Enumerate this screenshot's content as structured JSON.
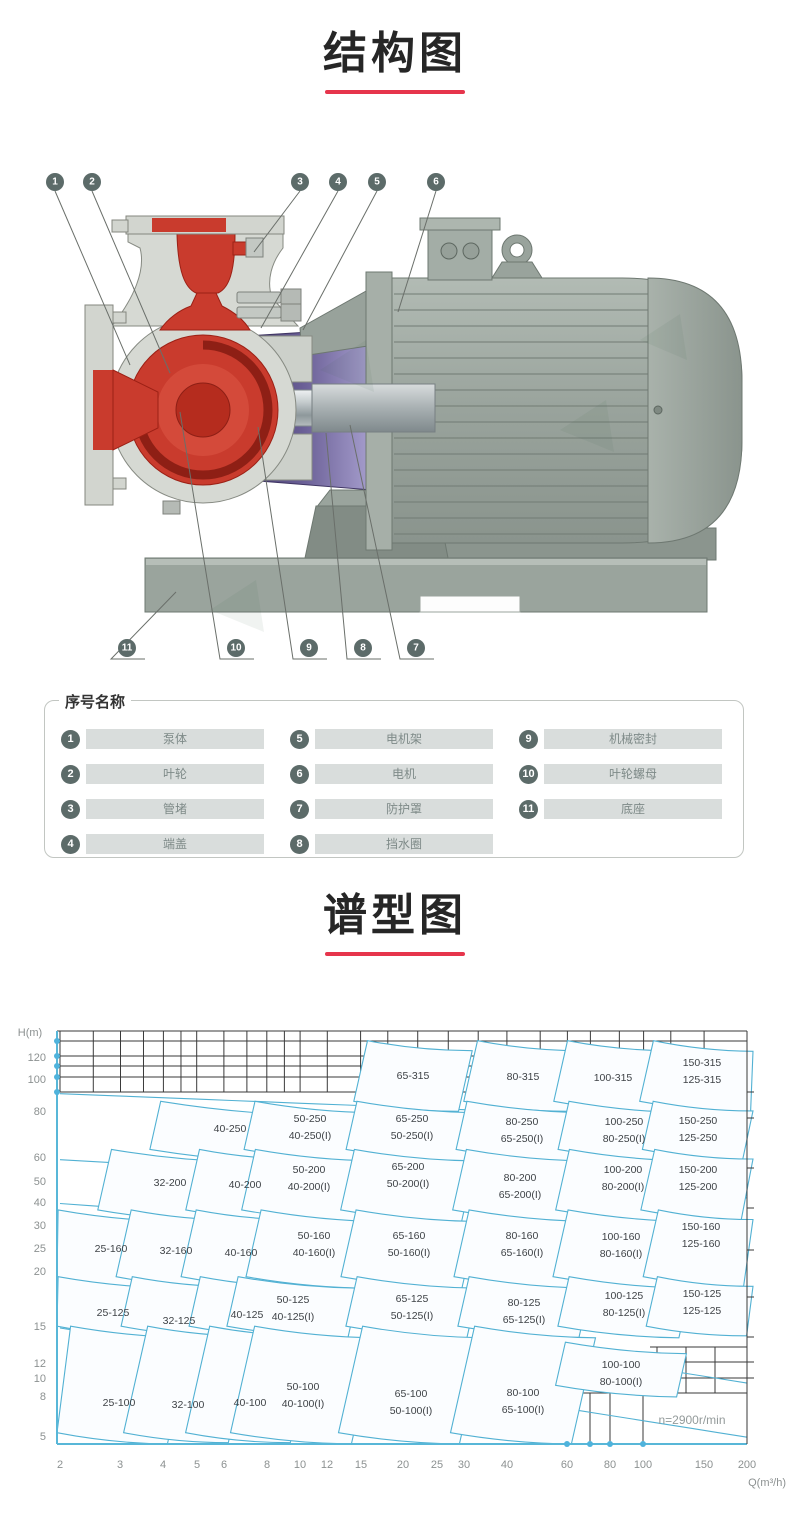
{
  "sections": {
    "structure": {
      "title": "结构图"
    },
    "spectrum": {
      "title": "谱型图"
    }
  },
  "accent_color": "#e6354c",
  "structure": {
    "callouts_top": [
      {
        "n": "1",
        "x": 55,
        "tx": 130,
        "ty": 235
      },
      {
        "n": "2",
        "x": 92,
        "tx": 170,
        "ty": 243
      },
      {
        "n": "3",
        "x": 300,
        "tx": 254,
        "ty": 122
      },
      {
        "n": "4",
        "x": 338,
        "tx": 261,
        "ty": 198
      },
      {
        "n": "5",
        "x": 377,
        "tx": 303,
        "ty": 200
      },
      {
        "n": "6",
        "x": 436,
        "tx": 398,
        "ty": 182
      }
    ],
    "callouts_bottom": [
      {
        "n": "11",
        "x": 127,
        "tx": 176,
        "ty": 462
      },
      {
        "n": "10",
        "x": 236,
        "tx": 180,
        "ty": 282
      },
      {
        "n": "9",
        "x": 309,
        "tx": 258,
        "ty": 297
      },
      {
        "n": "8",
        "x": 363,
        "tx": 326,
        "ty": 303
      },
      {
        "n": "7",
        "x": 416,
        "tx": 350,
        "ty": 295
      }
    ]
  },
  "parts": {
    "legend": "序号名称",
    "items": [
      {
        "no": "1",
        "name": "泵体"
      },
      {
        "no": "2",
        "name": "叶轮"
      },
      {
        "no": "3",
        "name": "管堵"
      },
      {
        "no": "4",
        "name": "端盖"
      },
      {
        "no": "5",
        "name": "电机架"
      },
      {
        "no": "6",
        "name": "电机"
      },
      {
        "no": "7",
        "name": "防护罩"
      },
      {
        "no": "8",
        "name": "挡水圈"
      },
      {
        "no": "9",
        "name": "机械密封"
      },
      {
        "no": "10",
        "name": "叶轮螺母"
      },
      {
        "no": "11",
        "name": "底座"
      }
    ]
  },
  "chart_data": {
    "type": "area",
    "title": "谱型图",
    "xlabel": "Q(m³/h)",
    "ylabel": "H(m)",
    "x_scale": "log",
    "y_scale": "log",
    "xlim": [
      2,
      200
    ],
    "ylim": [
      5,
      150
    ],
    "annotation": "n=2900r/min",
    "grid": "partial-top-and-bottom-right",
    "legend_position": "none",
    "x_ticks": [
      {
        "v": "2",
        "px": 60
      },
      {
        "v": "3",
        "px": 120
      },
      {
        "v": "4",
        "px": 163
      },
      {
        "v": "5",
        "px": 197
      },
      {
        "v": "6",
        "px": 224
      },
      {
        "v": "8",
        "px": 267
      },
      {
        "v": "10",
        "px": 300
      },
      {
        "v": "12",
        "px": 327
      },
      {
        "v": "15",
        "px": 361
      },
      {
        "v": "20",
        "px": 403
      },
      {
        "v": "25",
        "px": 437
      },
      {
        "v": "30",
        "px": 464
      },
      {
        "v": "40",
        "px": 507
      },
      {
        "v": "60",
        "px": 567
      },
      {
        "v": "80",
        "px": 610
      },
      {
        "v": "100",
        "px": 643
      },
      {
        "v": "150",
        "px": 704
      },
      {
        "v": "200",
        "px": 747
      }
    ],
    "y_ticks": [
      {
        "v": "120",
        "py": 58
      },
      {
        "v": "100",
        "py": 80
      },
      {
        "v": "80",
        "py": 112
      },
      {
        "v": "60",
        "py": 158
      },
      {
        "v": "50",
        "py": 182
      },
      {
        "v": "40",
        "py": 203
      },
      {
        "v": "30",
        "py": 226
      },
      {
        "v": "25",
        "py": 249
      },
      {
        "v": "20",
        "py": 272
      },
      {
        "v": "15",
        "py": 327
      },
      {
        "v": "12",
        "py": 364
      },
      {
        "v": "10",
        "py": 379
      },
      {
        "v": "8",
        "py": 397
      },
      {
        "v": "5",
        "py": 437
      }
    ],
    "regions": [
      {
        "labels": [
          "65-315"
        ],
        "lx": 413,
        "ly": 76,
        "h1": 90,
        "h2": 150
      },
      {
        "labels": [
          "80-315"
        ],
        "lx": 523,
        "ly": 77,
        "h1": 90,
        "h2": 150
      },
      {
        "labels": [
          "100-315"
        ],
        "lx": 613,
        "ly": 78,
        "h1": 90,
        "h2": 150
      },
      {
        "labels": [
          "150-315",
          "125-315"
        ],
        "lx": 702,
        "ly": 63,
        "h1": 90,
        "h2": 150,
        "wf": 1.45
      },
      {
        "labels": [
          "40-250"
        ],
        "lx": 230,
        "ly": 129,
        "h1": 60,
        "h2": 90,
        "wf": 1.65
      },
      {
        "labels": [
          "50-250",
          "40-250(I)"
        ],
        "lx": 310,
        "ly": 119,
        "h1": 60,
        "h2": 90
      },
      {
        "labels": [
          "65-250",
          "50-250(I)"
        ],
        "lx": 412,
        "ly": 119,
        "h1": 60,
        "h2": 90
      },
      {
        "labels": [
          "80-250",
          "65-250(I)"
        ],
        "lx": 522,
        "ly": 122,
        "h1": 60,
        "h2": 90
      },
      {
        "labels": [
          "100-250",
          "80-250(I)"
        ],
        "lx": 624,
        "ly": 122,
        "h1": 60,
        "h2": 90
      },
      {
        "labels": [
          "150-250",
          "125-250"
        ],
        "lx": 698,
        "ly": 121,
        "h1": 60,
        "h2": 90,
        "wf": 1.4
      },
      {
        "labels": [
          "32-200"
        ],
        "lx": 170,
        "ly": 183,
        "h1": 36,
        "h2": 60,
        "wf": 1.55
      },
      {
        "labels": [
          "40-200"
        ],
        "lx": 245,
        "ly": 185,
        "h1": 36,
        "h2": 60
      },
      {
        "labels": [
          "50-200",
          "40-200(I)"
        ],
        "lx": 309,
        "ly": 170,
        "h1": 36,
        "h2": 60
      },
      {
        "labels": [
          "65-200",
          "50-200(I)"
        ],
        "lx": 408,
        "ly": 167,
        "h1": 36,
        "h2": 60
      },
      {
        "labels": [
          "80-200",
          "65-200(I)"
        ],
        "lx": 520,
        "ly": 178,
        "h1": 36,
        "h2": 60
      },
      {
        "labels": [
          "100-200",
          "80-200(I)"
        ],
        "lx": 623,
        "ly": 170,
        "h1": 36,
        "h2": 60
      },
      {
        "labels": [
          "150-200",
          "125-200"
        ],
        "lx": 698,
        "ly": 170,
        "h1": 36,
        "h2": 60,
        "wf": 1.4
      },
      {
        "labels": [
          "25-160"
        ],
        "lx": 111,
        "ly": 249,
        "h1": 20.5,
        "h2": 36,
        "wf": 1.5
      },
      {
        "labels": [
          "32-160"
        ],
        "lx": 176,
        "ly": 251,
        "h1": 20.5,
        "h2": 36
      },
      {
        "labels": [
          "40-160"
        ],
        "lx": 241,
        "ly": 253,
        "h1": 20.5,
        "h2": 36
      },
      {
        "labels": [
          "50-160",
          "40-160(I)"
        ],
        "lx": 314,
        "ly": 236,
        "h1": 20.5,
        "h2": 36
      },
      {
        "labels": [
          "65-160",
          "50-160(I)"
        ],
        "lx": 409,
        "ly": 236,
        "h1": 20.5,
        "h2": 36
      },
      {
        "labels": [
          "80-160",
          "65-160(I)"
        ],
        "lx": 522,
        "ly": 236,
        "h1": 20.5,
        "h2": 36
      },
      {
        "labels": [
          "100-160",
          "80-160(I)"
        ],
        "lx": 621,
        "ly": 237,
        "h1": 20.5,
        "h2": 36
      },
      {
        "labels": [
          "150-160",
          "125-160"
        ],
        "lx": 701,
        "ly": 227,
        "h1": 20.5,
        "h2": 36,
        "wf": 1.4
      },
      {
        "labels": [
          "25-125"
        ],
        "lx": 113,
        "ly": 313,
        "h1": 13.5,
        "h2": 20.5,
        "wf": 1.5
      },
      {
        "labels": [
          "32-125"
        ],
        "lx": 179,
        "ly": 321,
        "h1": 13.5,
        "h2": 20.5
      },
      {
        "labels": [
          "40-125"
        ],
        "lx": 247,
        "ly": 315,
        "h1": 13.5,
        "h2": 20.5
      },
      {
        "labels": [
          "50-125",
          "40-125(I)"
        ],
        "lx": 293,
        "ly": 300,
        "h1": 13.5,
        "h2": 20.5
      },
      {
        "labels": [
          "65-125",
          "50-125(I)"
        ],
        "lx": 412,
        "ly": 299,
        "h1": 13.5,
        "h2": 20.5
      },
      {
        "labels": [
          "80-125",
          "65-125(I)"
        ],
        "lx": 524,
        "ly": 303,
        "h1": 13.5,
        "h2": 20.5
      },
      {
        "labels": [
          "100-125",
          "80-125(I)"
        ],
        "lx": 624,
        "ly": 296,
        "h1": 13.5,
        "h2": 20.5
      },
      {
        "labels": [
          "150-125",
          "125-125"
        ],
        "lx": 702,
        "ly": 294,
        "h1": 13.5,
        "h2": 20.5,
        "wf": 1.4
      },
      {
        "labels": [
          "25-100"
        ],
        "lx": 119,
        "ly": 403,
        "h1": 5.5,
        "h2": 13.5,
        "wf": 1.5
      },
      {
        "labels": [
          "32-100"
        ],
        "lx": 188,
        "ly": 405,
        "h1": 5.5,
        "h2": 13.5
      },
      {
        "labels": [
          "40-100"
        ],
        "lx": 250,
        "ly": 403,
        "h1": 5.5,
        "h2": 13.5
      },
      {
        "labels": [
          "50-100",
          "40-100(I)"
        ],
        "lx": 303,
        "ly": 387,
        "h1": 5.5,
        "h2": 13.5
      },
      {
        "labels": [
          "65-100",
          "50-100(I)"
        ],
        "lx": 411,
        "ly": 394,
        "h1": 5.5,
        "h2": 13.5
      },
      {
        "labels": [
          "80-100",
          "65-100(I)"
        ],
        "lx": 523,
        "ly": 393,
        "h1": 5.5,
        "h2": 13.5
      },
      {
        "labels": [
          "100-100",
          "80-100(I)"
        ],
        "lx": 621,
        "ly": 365,
        "h1": 8.2,
        "h2": 11.8,
        "wf": 1.5
      }
    ],
    "colors": {
      "region_stroke": "#52b1d3",
      "region_fill": "#fbfdff",
      "axis_blue": "#58b7d8",
      "grid_black": "#3a3a3a",
      "label_text": "#3f4347",
      "tick_text": "#8c9191"
    }
  }
}
